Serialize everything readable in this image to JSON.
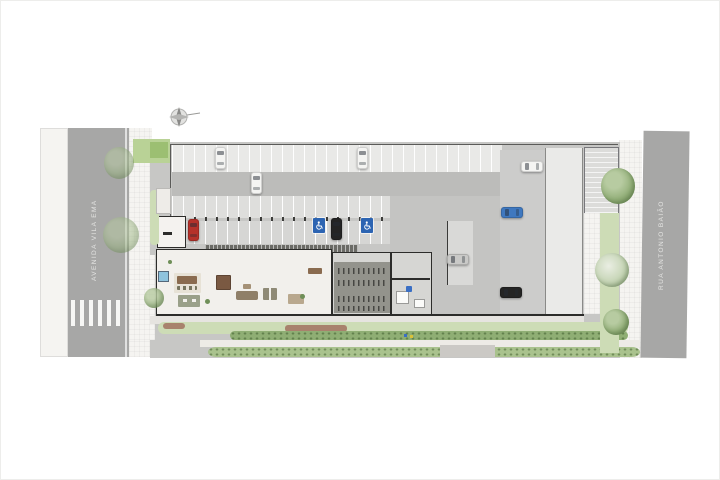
{
  "title": "ground-floor-site-plan",
  "streets": {
    "left_label": "AVENIDA VILA EMA",
    "right_label": "RUA ANTONIO BAIÃO"
  },
  "icons": {
    "north_arrow": "north-arrow",
    "accessible_parking": "wheelchair-symbol"
  },
  "colors": {
    "street": "#a7a7a6",
    "accessible_blue": "#2c64b2",
    "car_white": "#f4f4f2",
    "car_red": "#b5312a",
    "car_black": "#242424",
    "car_blue": "#3f78c0",
    "car_silver": "#c9c9c7",
    "landscape_green": "#a9c28d",
    "pool_blue": "#8fc3dd"
  },
  "cars": [
    {
      "color": "car_white",
      "orientation": "v",
      "x": 215,
      "y": 147
    },
    {
      "color": "car_white",
      "orientation": "v",
      "x": 251,
      "y": 172
    },
    {
      "color": "car_white",
      "orientation": "v",
      "x": 357,
      "y": 147
    },
    {
      "color": "car_red",
      "orientation": "v",
      "x": 188,
      "y": 219
    },
    {
      "color": "car_black",
      "orientation": "v",
      "x": 331,
      "y": 218
    },
    {
      "color": "car_white",
      "orientation": "h",
      "x": 521,
      "y": 161
    },
    {
      "color": "car_blue",
      "orientation": "h",
      "x": 501,
      "y": 207
    },
    {
      "color": "car_silver",
      "orientation": "h",
      "x": 447,
      "y": 254
    },
    {
      "color": "car_black",
      "orientation": "h",
      "x": 500,
      "y": 287
    }
  ],
  "accessible_stalls": [
    {
      "x": 313,
      "y": 218
    },
    {
      "x": 361,
      "y": 218
    }
  ],
  "markers": {
    "elevator_sign": {
      "x": 406,
      "y": 286
    },
    "blue_dot": {
      "x": 404,
      "y": 334
    },
    "yellow_dot": {
      "x": 410,
      "y": 335
    }
  }
}
